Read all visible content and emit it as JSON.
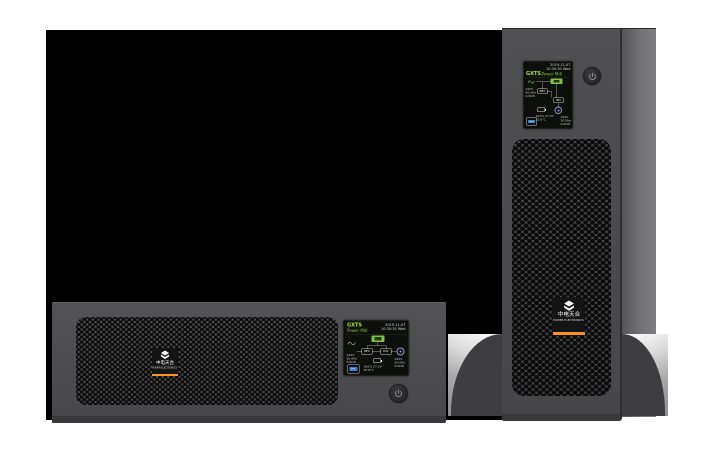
{
  "brand": {
    "chinese": "中电天合",
    "tagline": "POWER ELECTRONICS",
    "accent_color": "#f7941d",
    "logo_glyph": "chevron-diamond"
  },
  "lcd": {
    "model": "GXTS",
    "mode": "Power Mdl",
    "date": "2019-11-07",
    "time": "10:30:30 Wed",
    "rectifier_label": "REC",
    "inverter_label": "INV",
    "input_rows": [
      "220V",
      "50.0Hz",
      "0.0kW"
    ],
    "output_rows": [
      "220V",
      "50.0Hz",
      "0.0kW"
    ],
    "battery_rows": [
      "100%  27.3V",
      "25.6°C"
    ]
  },
  "power_button": {
    "label": "power"
  }
}
